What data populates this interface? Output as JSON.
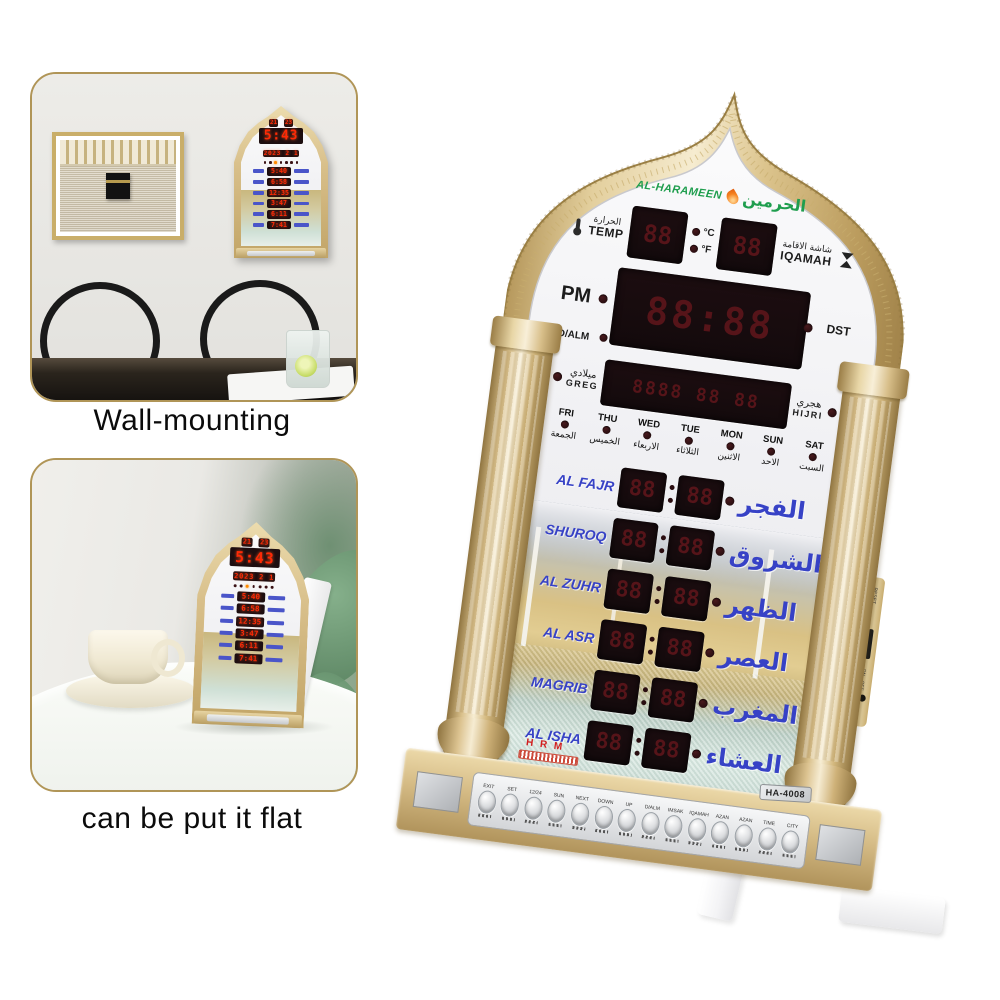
{
  "insets": {
    "wall": {
      "caption": "Wall-mounting"
    },
    "flat": {
      "caption": "can be put it flat"
    }
  },
  "clock": {
    "brand": {
      "name_en": "AL-HARAMEEN",
      "name_ar": "الحرمين"
    },
    "model": "HA-4008",
    "maker_mark": "H R M",
    "temp": {
      "label_en": "TEMP",
      "label_ar": "الحرارة"
    },
    "iqamah": {
      "label_en": "IQAMAH",
      "label_ar": "شاشة الاقامة"
    },
    "indicators": {
      "pm": "PM",
      "dst": "DST",
      "dalm": "D/ALM",
      "celsius": "°C",
      "fahrenheit": "°F"
    },
    "greg": {
      "label_en": "GREG",
      "label_ar": "ميلادي"
    },
    "hijri": {
      "label_en": "HIJRI",
      "label_ar": "هجري"
    },
    "days": [
      {
        "en": "FRI",
        "ar": "الجمعة"
      },
      {
        "en": "THU",
        "ar": "الخميس"
      },
      {
        "en": "WED",
        "ar": "الاربعاء"
      },
      {
        "en": "TUE",
        "ar": "الثلاثاء"
      },
      {
        "en": "MON",
        "ar": "الاثنين"
      },
      {
        "en": "SUN",
        "ar": "الاحد"
      },
      {
        "en": "SAT",
        "ar": "السبت"
      }
    ],
    "prayers": [
      {
        "en": "AL FAJR",
        "ar": "الفجر"
      },
      {
        "en": "SHUROQ",
        "ar": "الشروق"
      },
      {
        "en": "AL ZUHR",
        "ar": "الظهر"
      },
      {
        "en": "AL ASR",
        "ar": "العصر"
      },
      {
        "en": "MAGRIB",
        "ar": "المغرب"
      },
      {
        "en": "AL ISHA",
        "ar": "العشاء"
      }
    ],
    "ghost": {
      "two": "88",
      "time": "88:88",
      "date": "8888 88 88"
    },
    "buttons": [
      "EXIT",
      "SET",
      "12/24",
      "SUN",
      "NEXT",
      "DOWN",
      "UP",
      "D/ALM",
      "IMSAK",
      "IQAMAH",
      "AZAN",
      "AZAN",
      "TIME",
      "CITY"
    ],
    "side_labels": [
      "RESET",
      "ON",
      "OFF"
    ]
  },
  "display": {
    "temp": "21",
    "iqamah": "23",
    "time": "5:43",
    "date": "2023 2 1",
    "times": [
      "5:40",
      "6:58",
      "12:35",
      "3:47",
      "6:11",
      "7:41"
    ]
  },
  "colors": {
    "gold": "#d9c18a",
    "face": "#f1f1f4",
    "led_red": "#ff2a06",
    "label_blue": "#3a45c8",
    "logo_green": "#1f9e4e",
    "flame_orange": "#f58220"
  }
}
